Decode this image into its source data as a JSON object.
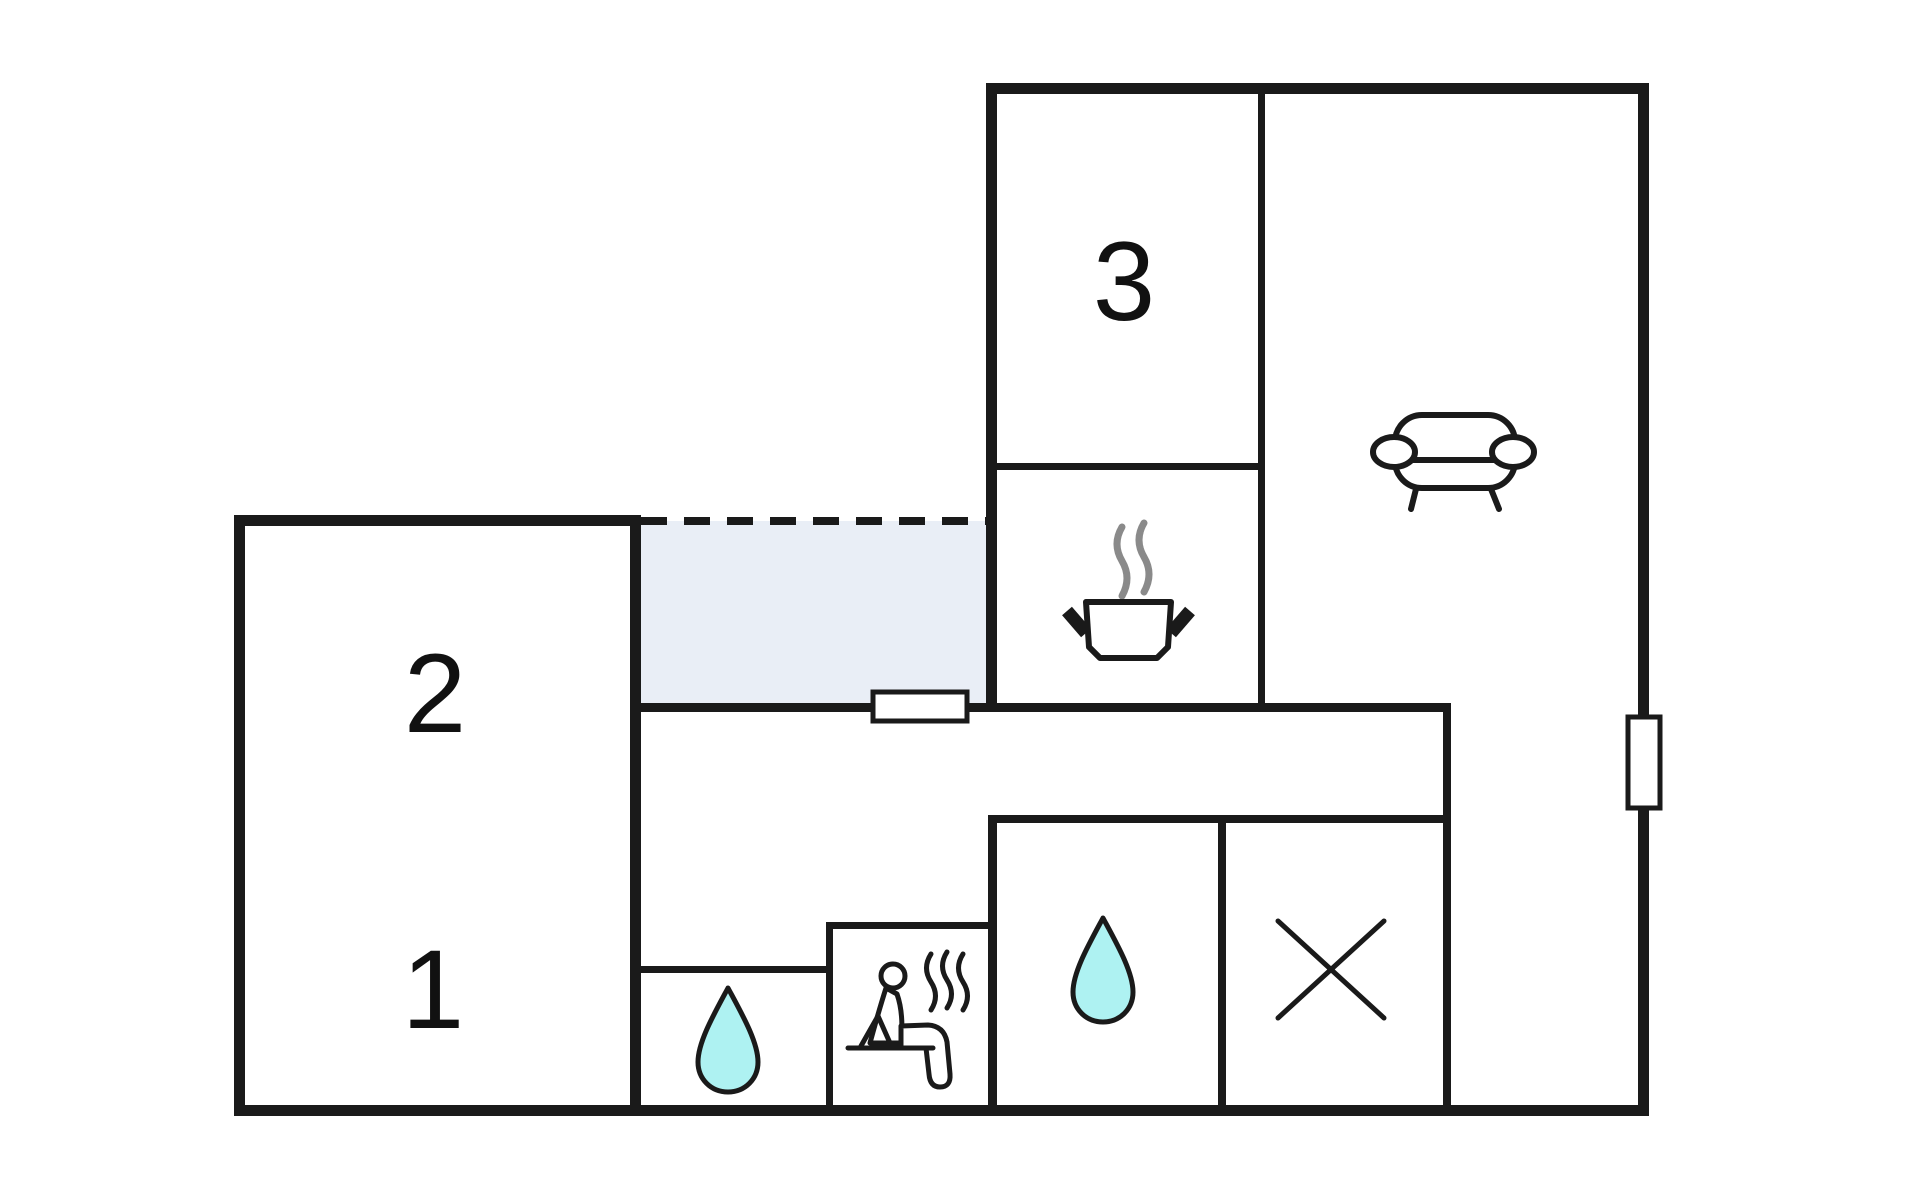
{
  "diagram": {
    "type": "floor-plan",
    "title": "holiday-home floor plan with three numbered rooms",
    "rooms": {
      "room1": {
        "label": "1",
        "kind": "bedroom"
      },
      "room2": {
        "label": "2",
        "kind": "bedroom"
      },
      "room3": {
        "label": "3",
        "kind": "bedroom"
      },
      "kitchen": {
        "icon": "cooking-pot-icon"
      },
      "living_room": {
        "icon": "sofa-icon"
      },
      "bathroom_small": {
        "icon": "water-drop-icon"
      },
      "bathroom_large": {
        "icon": "water-drop-icon"
      },
      "sauna": {
        "icon": "sauna-person-icon"
      },
      "utility": {
        "icon": "x-mark-icon"
      },
      "terrace": {
        "style": "shaded area with dashed open edge"
      },
      "hallway": {
        "style": "open corridor"
      }
    },
    "doors": [
      {
        "name": "hall-terrace-door",
        "orientation": "horizontal"
      },
      {
        "name": "right-wall-door",
        "orientation": "vertical"
      }
    ]
  },
  "colors": {
    "wall": "#1a1a1a",
    "background": "#ffffff",
    "terrace_fill": "#e9eef6",
    "water_drop_fill": "#aef2f2",
    "steam_gray": "#8a8a8a"
  }
}
